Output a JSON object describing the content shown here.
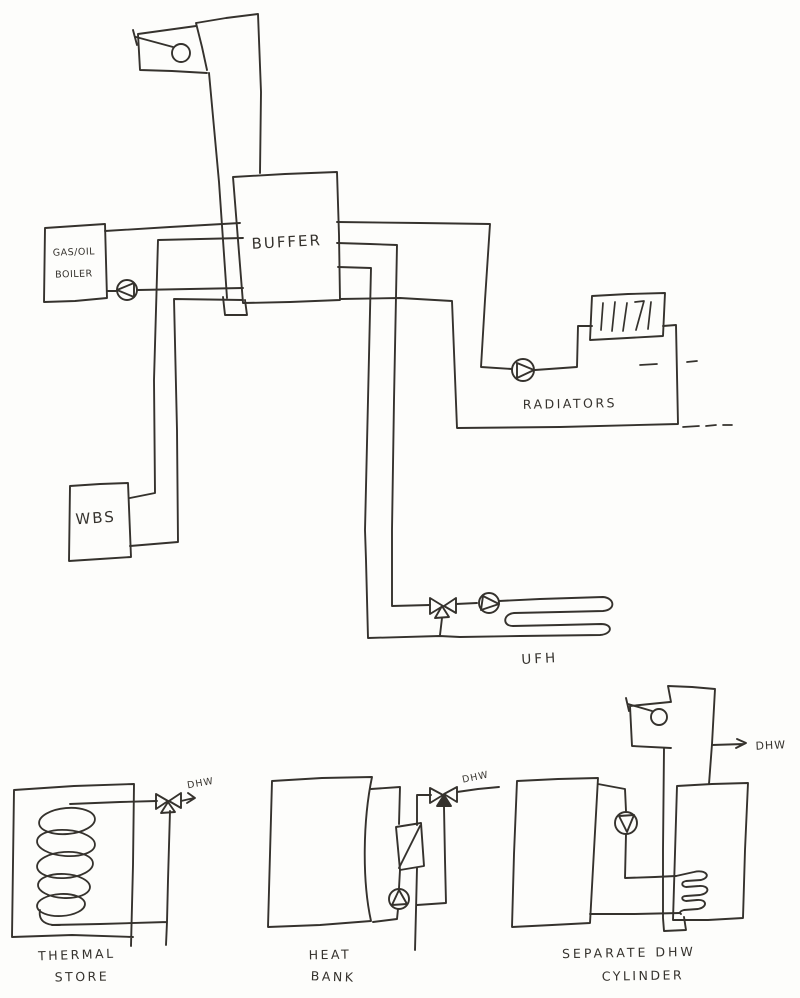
{
  "colors": {
    "ink": "#35322d",
    "paper": "#fdfdfb"
  },
  "labels": {
    "buffer": "BUFFER",
    "boiler_line1": "GAS/OIL",
    "boiler_line2": "BOILER",
    "wbs": "WBS",
    "radiators": "RADIATORS",
    "ufh": "UFH",
    "thermal_store_dhw": "DHW",
    "thermal_store_line1": "THERMAL",
    "thermal_store_line2": "STORE",
    "heat_bank_dhw": "DHW",
    "heat_bank_line1": "HEAT",
    "heat_bank_line2": "BANK",
    "separate_cylinder_dhw": "DHW",
    "separate_cylinder_line1": "SEPARATE DHW",
    "separate_cylinder_line2": "CYLINDER"
  }
}
